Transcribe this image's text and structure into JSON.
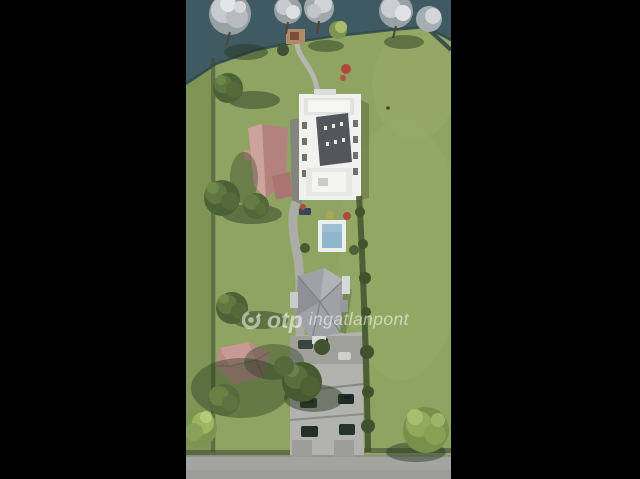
{
  "image": {
    "kind": "aerial-3d-architectural-rendering",
    "description": "Top-down 3D rendering of a lakeside plot: waterfront with trees, white apartment building, two pink-roof houses, gray-roof house, swimming pool, parking courtyard with cars, road at bottom, black letterbox bars left and right"
  },
  "watermark": {
    "logo": "otp-circular-logo",
    "brand": "otp",
    "suffix": "ingatlanpont"
  },
  "colors": {
    "letterbox": "#000000",
    "grass": "#8fa462",
    "grassLight": "#9ab06a",
    "water": "#3f5a62",
    "waterEdge": "#2c444c",
    "path": "#b5b7b1",
    "pavement": "#b2b3ae",
    "road": "#a4a4a0",
    "buildingWhite": "#f1f2f0",
    "roofDark": "#53565b",
    "pinkRoof": "#b4827e",
    "pinkRoofLight": "#cda39e",
    "lowerRoof": "#a0a1a7",
    "poolWater": "#8fb6ca",
    "poolDeck": "#eceded",
    "treeGreen": "#5d7440",
    "treeDark": "#41522e",
    "treeLight": "#9cb467",
    "treeSilver": "#ccd1d5",
    "carDark": "#2b3a34",
    "redBush": "#b0473c",
    "shadow": "rgba(35,52,28,0.45)",
    "watermark": "rgba(255,255,255,0.55)"
  }
}
